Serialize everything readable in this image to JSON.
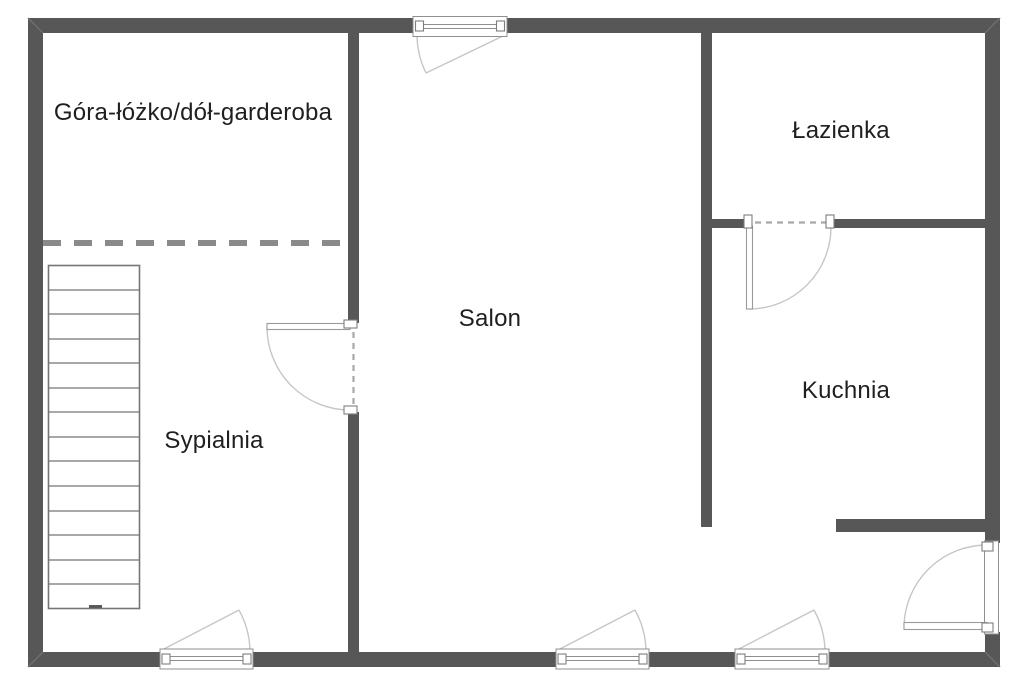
{
  "rooms": [
    {
      "name": "garderoba",
      "label": "Góra-łóżko/dół-garderoba"
    },
    {
      "name": "sypialnia",
      "label": "Sypialnia"
    },
    {
      "name": "salon",
      "label": "Salon"
    },
    {
      "name": "lazienka",
      "label": "Łazienka"
    },
    {
      "name": "kuchnia",
      "label": "Kuchnia"
    }
  ],
  "symbols": {
    "stairs": "staircase-14-treads",
    "partition": "dashed-partition-line",
    "doors": [
      "bedroom-door",
      "bathroom-door",
      "entrance-door"
    ],
    "windows": [
      "top-window",
      "bedroom-window",
      "living-room-window",
      "kitchen-window"
    ]
  },
  "colors": {
    "bg": "#ffffff",
    "wall": "#575757",
    "bevel": "#6f6f6f",
    "dash": "#8a8a8a",
    "door-dash": "#a8a8a8",
    "arc": "#c6c6c6",
    "frame": "#8f8f8f",
    "leaf": "#9a9a9a",
    "stairs": "#757575",
    "text": "#1f1f1f"
  }
}
